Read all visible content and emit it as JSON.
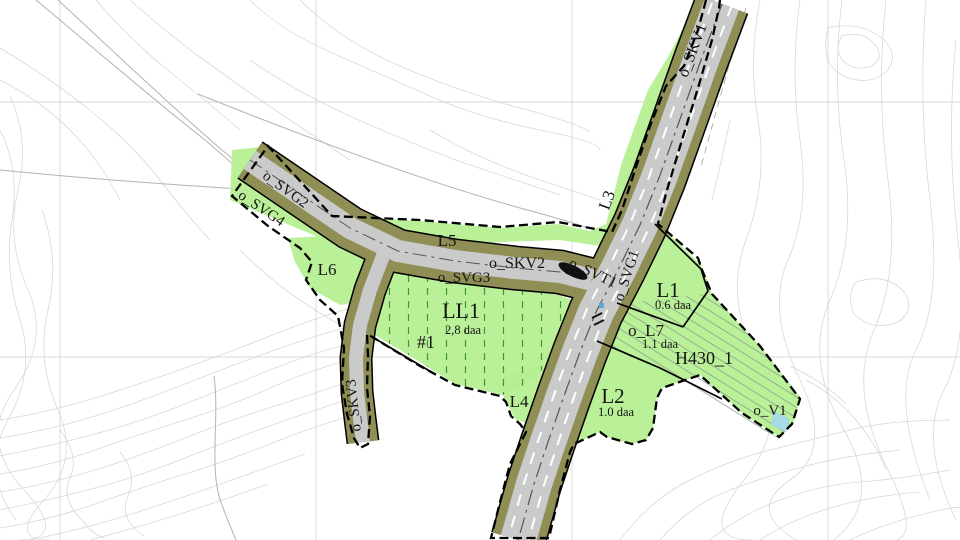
{
  "map": {
    "colors": {
      "road": "#cacaca",
      "verge": "#8e8e55",
      "area_green": "#b5ef90",
      "water": "#a8dbe8",
      "agri_dash": "#3e9440",
      "hatch": "#8f9f8f",
      "contour": "#d8d8d8",
      "grid": "#cccccc",
      "basemap": "#b3b3b3",
      "boundary": "#000000",
      "marking": "#555555"
    },
    "labels": {
      "skv1": "o_SKV1",
      "svg2": "o_SVG2",
      "svg4": "o_SVG4",
      "l5": "L5",
      "skv2": "o_SKV2",
      "svt1": "o_SVT1",
      "l3": "L3",
      "svg1": "o_SVG1",
      "svg3": "o_SVG3",
      "l6": "L6",
      "ll1": "LL1",
      "ll1_area": "2,8 daa",
      "unit1": "#1",
      "l4": "L4",
      "l2": "L2",
      "l2_area": "1.0 daa",
      "l1": "L1",
      "l1_area": "0.6 daa",
      "l7": "o_L7",
      "l7_area": "1.1 daa",
      "h430": "H430_1",
      "v1": "o_V1",
      "skv3": "o_SKV3"
    }
  }
}
